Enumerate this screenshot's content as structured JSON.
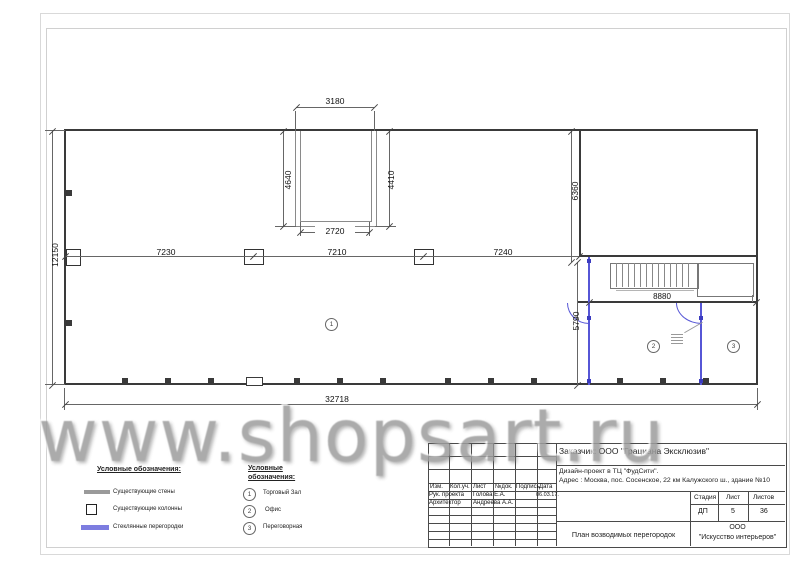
{
  "watermark": "www.shopsart.ru",
  "plan": {
    "dimensions": {
      "overall_width": "32718",
      "overall_height": "12150",
      "bays": [
        "7230",
        "7210",
        "7240"
      ],
      "opening": {
        "top": "3180",
        "left": "4640",
        "right": "4410",
        "bottom": "2720"
      },
      "right_section": {
        "upper": "6360",
        "lower": "5790",
        "width": "8880"
      }
    },
    "rooms": [
      {
        "num": "1"
      },
      {
        "num": "2"
      },
      {
        "num": "3"
      }
    ]
  },
  "legend_symbols": {
    "title": "Условные обозначения:",
    "items": [
      {
        "swatch": "existing-wall",
        "label": "Существующие стены"
      },
      {
        "swatch": "existing-column",
        "label": "Существующие колонны"
      },
      {
        "swatch": "glass-partition",
        "label": "Стеклянные перегородки"
      }
    ]
  },
  "legend_rooms": {
    "title_line1": "Условные",
    "title_line2": "обозначения:",
    "items": [
      {
        "num": "1",
        "label": "Торговый Зал"
      },
      {
        "num": "2",
        "label": "Офис"
      },
      {
        "num": "3",
        "label": "Переговорная"
      }
    ]
  },
  "title_block": {
    "customer": "Заказчик:  ООО \"Грациана Эксклюзив\"",
    "project": "Дизайн-проект в  ТЦ \"ФудСити\".",
    "address": "Адрес : Москва, пос. Сосенское, 22 км Калужского ш., здание №10",
    "columns": [
      "Изм.",
      "Кол.уч.",
      "Лист",
      "№док.",
      "Подпись",
      "Дата"
    ],
    "rows": [
      {
        "role": "Рук. проекта",
        "name": "Голова Е.А.",
        "date": "06.03.17."
      },
      {
        "role": "Архитектор",
        "name": "Андреева А.А.",
        "date": ""
      }
    ],
    "stage_label": "Стадия",
    "sheet_label": "Лист",
    "sheets_label": "Листов",
    "stage": "ДП",
    "sheet": "5",
    "sheets": "36",
    "drawing_title": "План возводимых перегородок",
    "company_line1": "ООО",
    "company_line2": "\"Искусство интерьеров\""
  },
  "colors": {
    "wall": "#3a3a3a",
    "existing": "#8a8a8a",
    "glass": "#5656d6",
    "dim": "#444444"
  }
}
